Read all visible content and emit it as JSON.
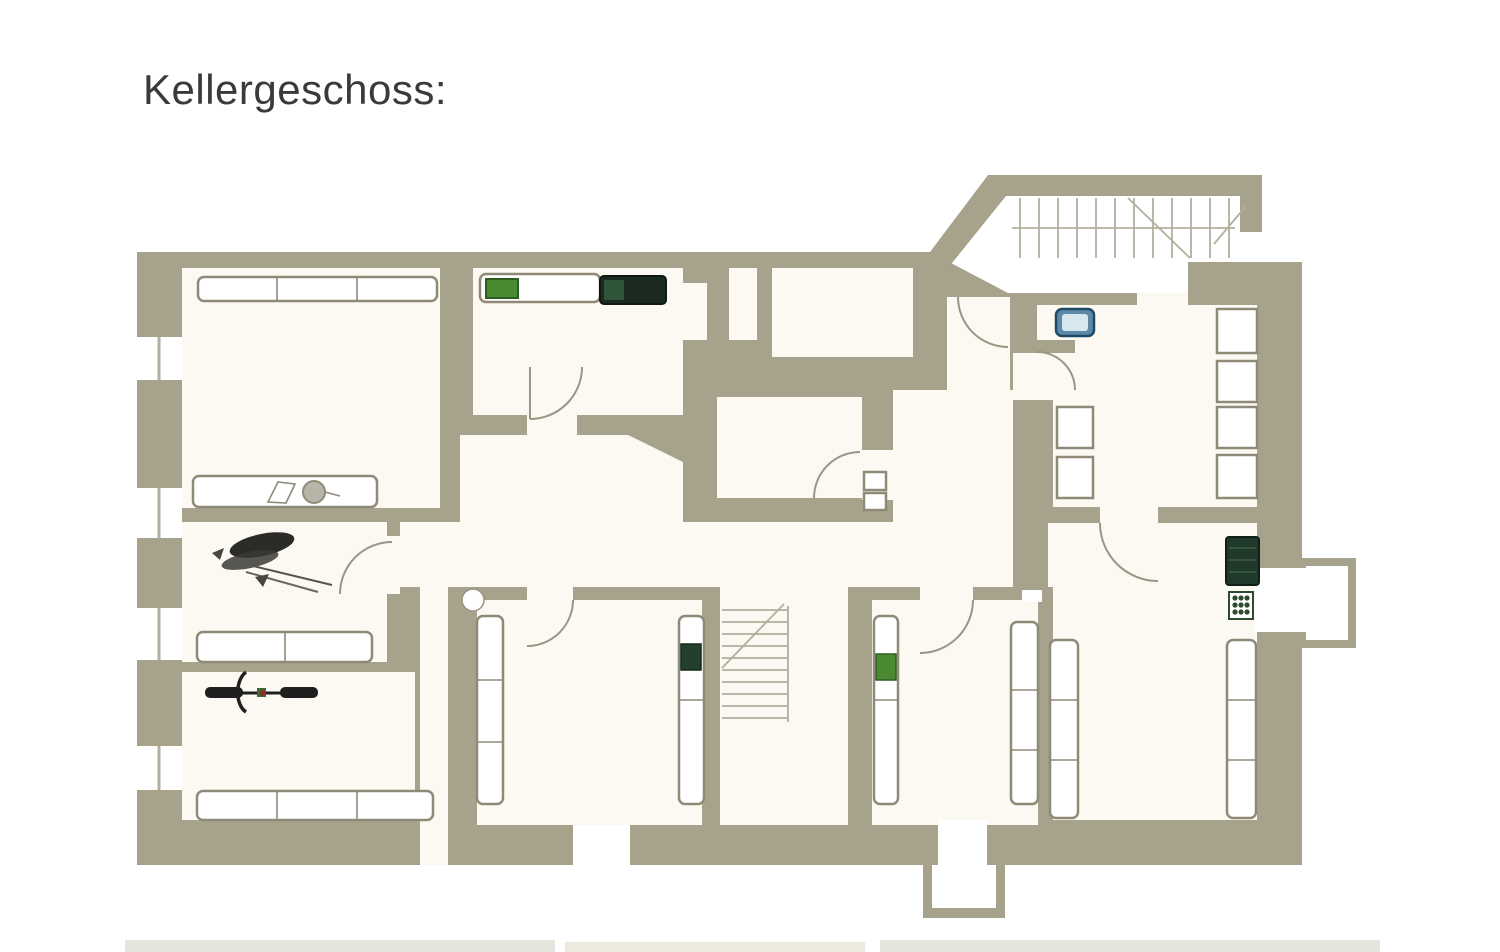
{
  "page": {
    "title": "Kellergeschoss:"
  },
  "colors": {
    "background": "#ffffff",
    "title_text": "#3a3a3a",
    "wall": "#a7a28c",
    "room": "#fbf9f1",
    "line": "#8f8a78",
    "arc": "#9a9584",
    "stair_line": "#b3ae9e",
    "appliance_dark": "#20392b",
    "boiler_dark": "#1b2a20",
    "boiler_inner": "#2f5438",
    "box_green": "#4a8a33",
    "box_green_dark": "#23402c",
    "sink_blue": "#5d89a8",
    "sink_light": "#d7e7f0",
    "bike_dark": "#1f1f1f",
    "tool_dark": "#2b2b28",
    "grinder_gray": "#b9b5a6",
    "page_edge": "#e6e5dd"
  },
  "floorplan": {
    "kind": "basement floor plan (scanned)",
    "rooms": [
      {
        "id": "top-left-cellar",
        "symbols": [
          "long-wall-shelf",
          "workbench",
          "vise",
          "bench-grinder"
        ]
      },
      {
        "id": "workshop",
        "symbols": [
          "power-drill",
          "hand-tools",
          "storage-shelf"
        ]
      },
      {
        "id": "bicycle-room",
        "symbols": [
          "bicycle",
          "long-wall-shelf"
        ]
      },
      {
        "id": "boiler-room",
        "symbols": [
          "wall-shelf",
          "green-crate",
          "boiler"
        ]
      },
      {
        "id": "small-north-room",
        "symbols": []
      },
      {
        "id": "meter-room",
        "symbols": [
          "meter-box",
          "meter-box",
          "door-arc"
        ]
      },
      {
        "id": "hallway",
        "symbols": [
          "door-arcs"
        ]
      },
      {
        "id": "north-east-room",
        "symbols": [
          "sink",
          "shelf-boxes"
        ]
      },
      {
        "id": "south-east-room",
        "symbols": [
          "washing-machine",
          "laundry-basket",
          "tall-shelves"
        ]
      },
      {
        "id": "storage-south-1",
        "symbols": [
          "tall-shelf",
          "tall-shelf",
          "dark-green-crate",
          "column"
        ]
      },
      {
        "id": "storage-south-2",
        "symbols": [
          "tall-shelf",
          "tall-shelf",
          "green-crate"
        ]
      },
      {
        "id": "stairwell-interior",
        "symbols": [
          "winder-stairs"
        ]
      },
      {
        "id": "entrance-north",
        "symbols": [
          "exterior-stairs"
        ]
      },
      {
        "id": "light-wells",
        "symbols": [
          "light-well-east",
          "light-well-south",
          "window-niches-west"
        ]
      }
    ]
  }
}
